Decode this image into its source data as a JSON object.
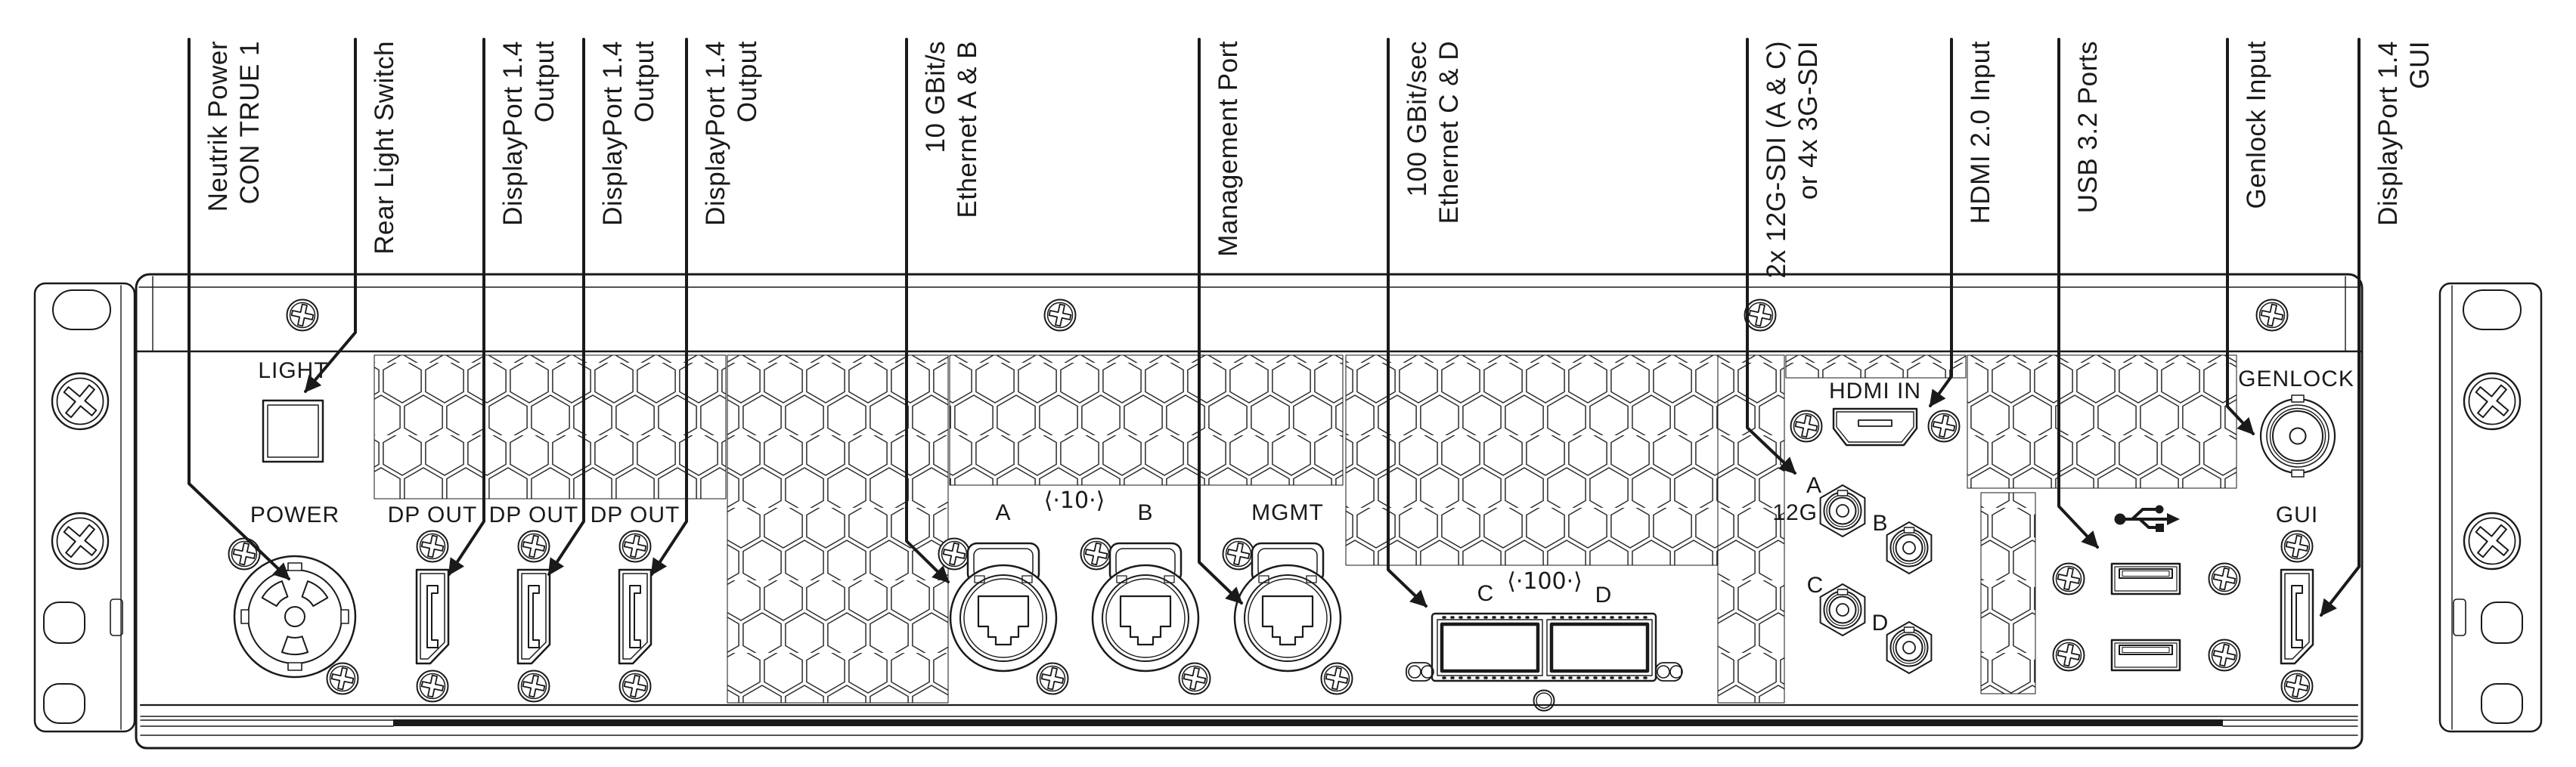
{
  "diagram": {
    "ink_color": "#1a1a1a",
    "background_color": "#ffffff"
  },
  "callouts": [
    {
      "label": "Neutrik Power",
      "label2": "CON TRUE 1"
    },
    {
      "label": "Rear Light Switch",
      "label2": ""
    },
    {
      "label": "DisplayPort 1.4",
      "label2": "Output"
    },
    {
      "label": "DisplayPort 1.4",
      "label2": "Output"
    },
    {
      "label": "DisplayPort 1.4",
      "label2": "Output"
    },
    {
      "label": "10 GBit/s",
      "label2": "Ethernet A & B"
    },
    {
      "label": "Management Port",
      "label2": ""
    },
    {
      "label": "100 GBit/sec",
      "label2": "Ethernet C & D"
    },
    {
      "label": "2x 12G-SDI (A & C)",
      "label2": "or 4x 3G-SDI"
    },
    {
      "label": "HDMI 2.0 Input",
      "label2": ""
    },
    {
      "label": "USB 3.2 Ports",
      "label2": ""
    },
    {
      "label": "Genlock Input",
      "label2": ""
    },
    {
      "label": "DisplayPort 1.4",
      "label2": "GUI"
    }
  ],
  "panel": {
    "light_label": "LIGHT",
    "power_label": "POWER",
    "dp_out_label": "DP OUT",
    "eth": {
      "a": "A",
      "speed": "⟨·10·⟩",
      "b": "B",
      "mgmt": "MGMT"
    },
    "qsfp": {
      "c": "C",
      "speed": "⟨·100·⟩",
      "d": "D"
    },
    "hdmi_label": "HDMI IN",
    "sdi": {
      "a": "A",
      "rate": "12G",
      "b": "B",
      "c": "C",
      "d": "D"
    },
    "genlock_label": "GENLOCK",
    "gui_label": "GUI"
  }
}
